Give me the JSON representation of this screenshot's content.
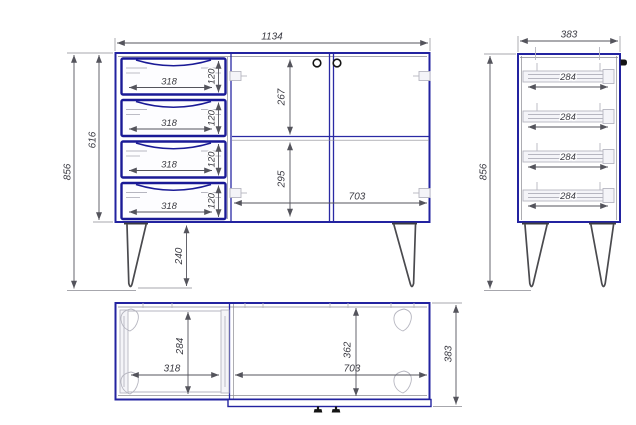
{
  "drawing": {
    "type": "furniture-technical-drawing",
    "colors": {
      "outline": "#2323a0",
      "drawer_outline": "#1a1a96",
      "hardware": "#b6b6c0",
      "dimension_text": "#3a3a42"
    },
    "views": {
      "front": {
        "width_total": "1134",
        "height_total": "856",
        "height_body": "616",
        "height_legs": "240",
        "section_top": "267",
        "section_bottom": "295",
        "door_width": "703",
        "drawers": [
          {
            "width": "318",
            "height": "120"
          },
          {
            "width": "318",
            "height": "120"
          },
          {
            "width": "318",
            "height": "120"
          },
          {
            "width": "318",
            "height": "120"
          }
        ]
      },
      "side": {
        "depth_total": "383",
        "height_total": "856",
        "slides": [
          {
            "length": "284"
          },
          {
            "length": "284"
          },
          {
            "length": "284"
          },
          {
            "length": "284"
          }
        ]
      },
      "top": {
        "drawer_depth": "284",
        "drawer_width": "318",
        "door_width": "703",
        "inner_depth": "362",
        "depth_total": "383"
      }
    }
  }
}
